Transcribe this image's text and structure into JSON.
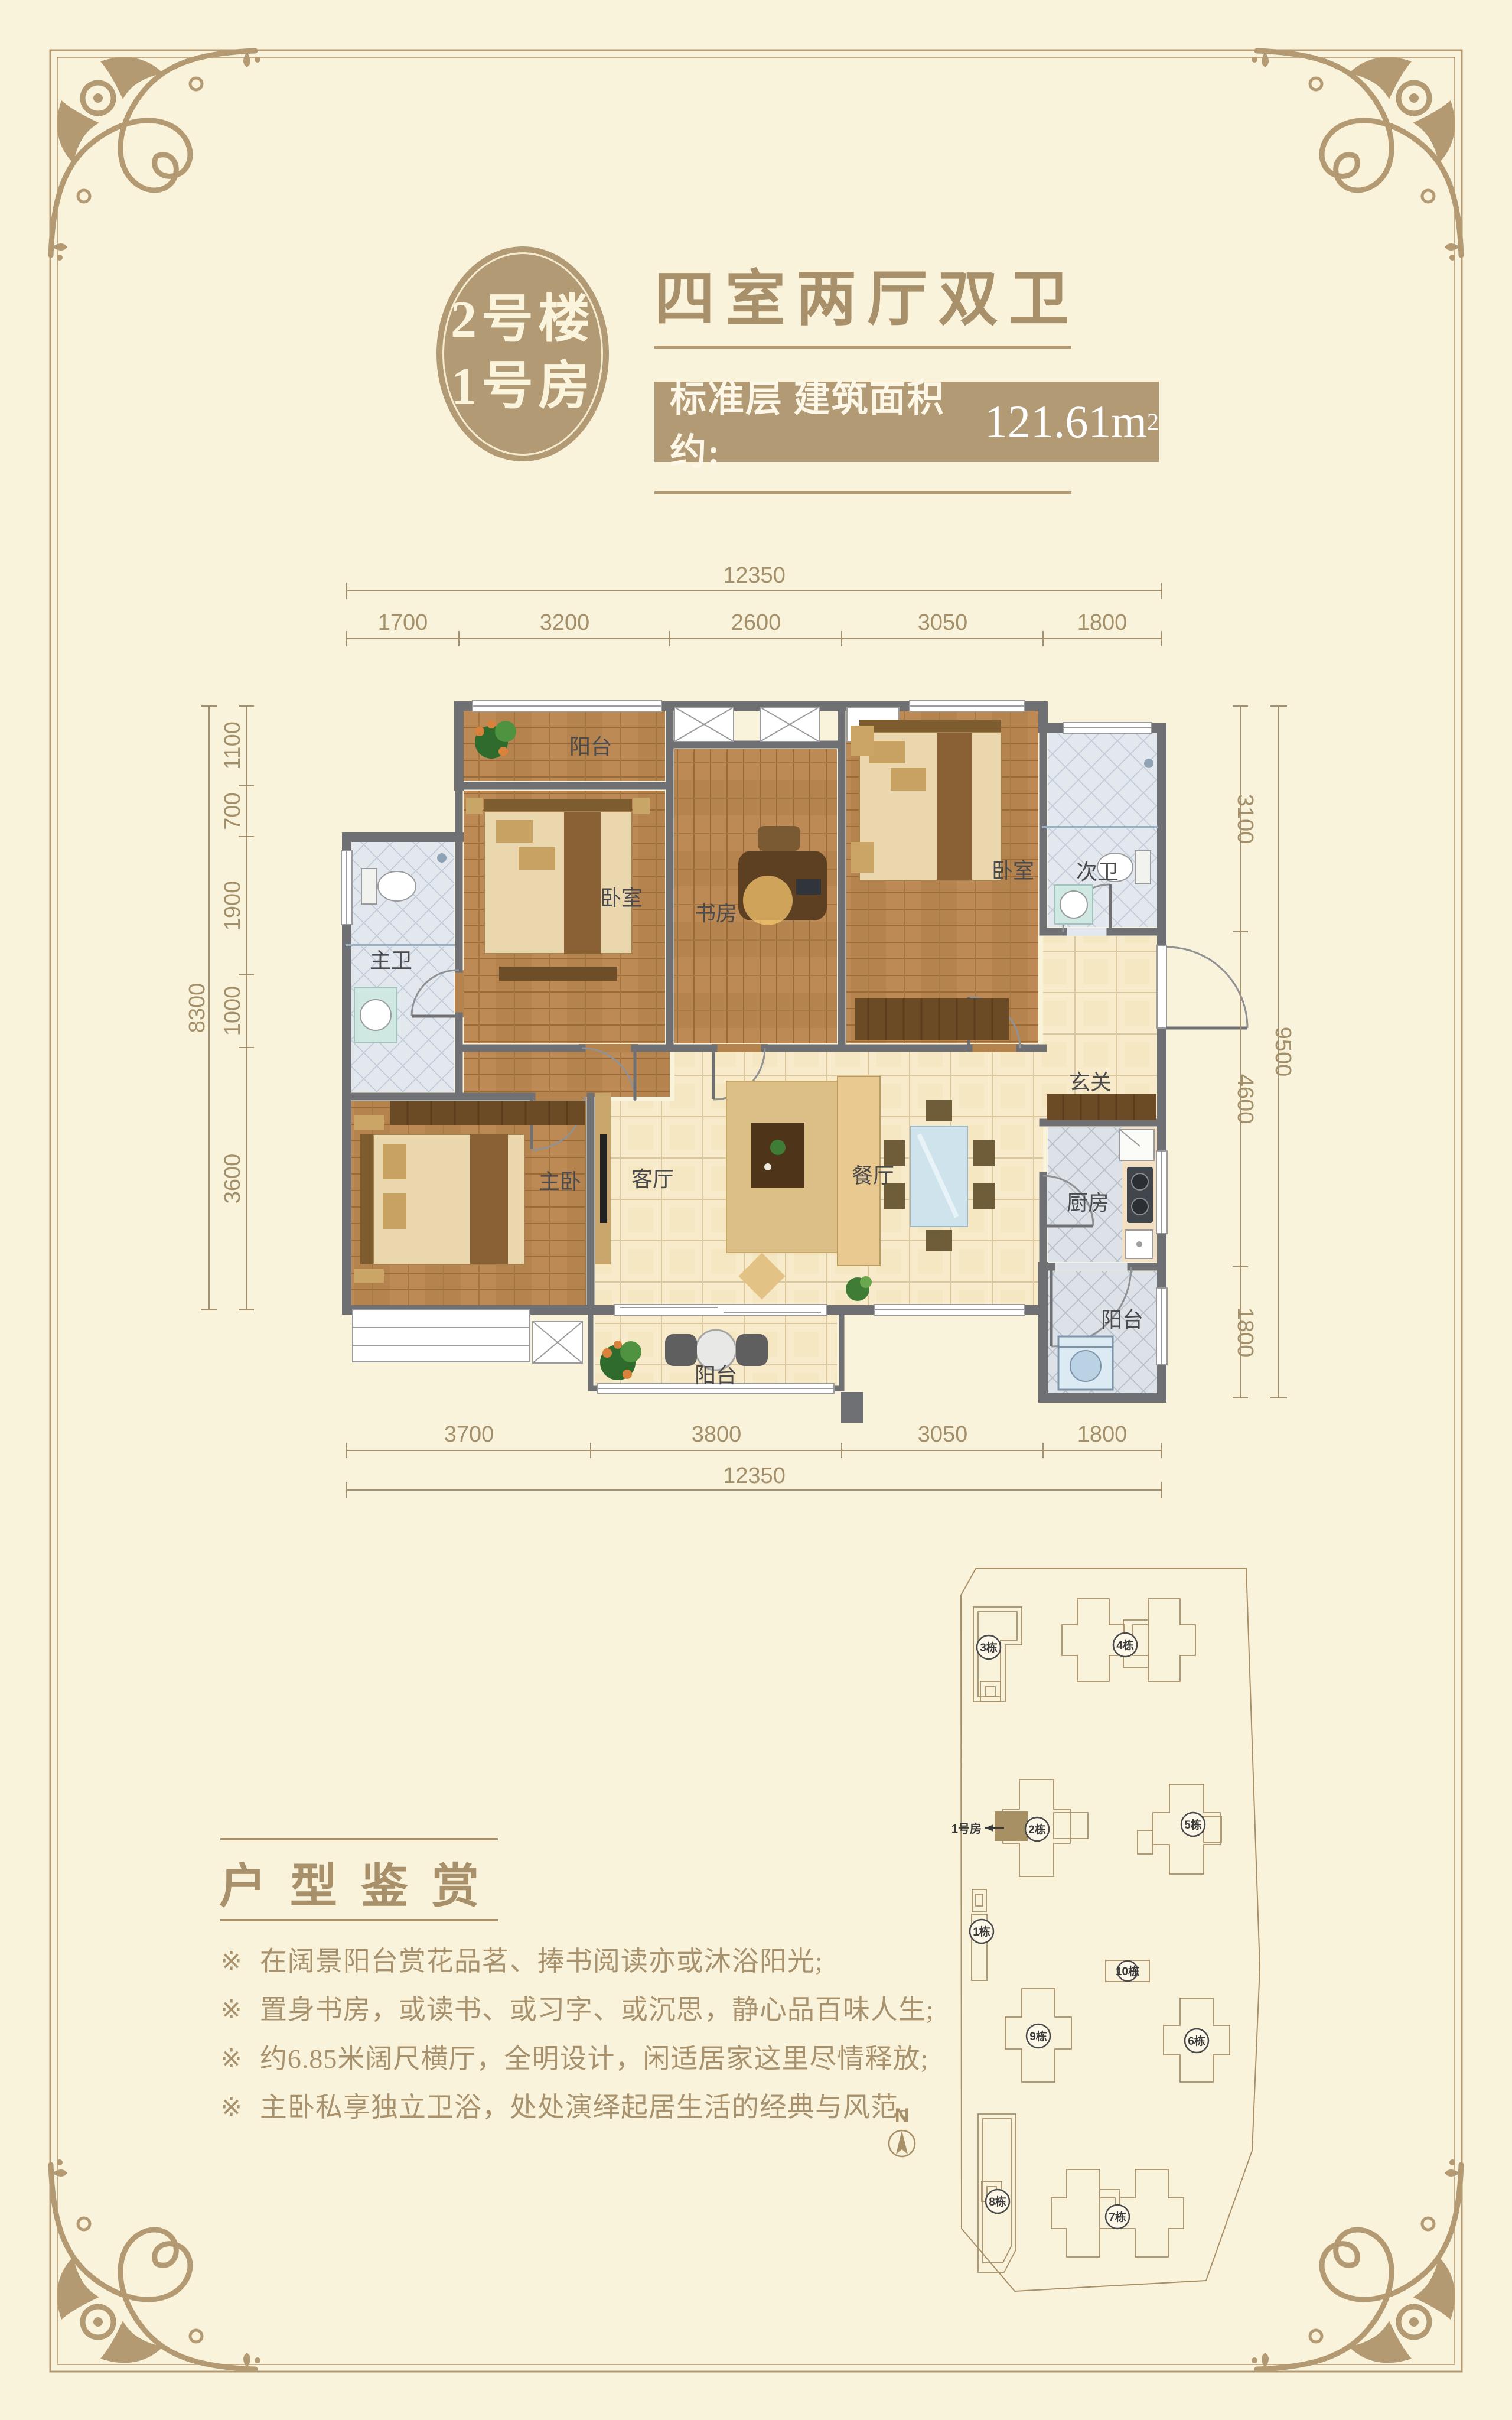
{
  "page": {
    "bg": "#faf3dc",
    "accent": "#b49a72",
    "accent_dark": "#a8906a",
    "banner_bg": "#b29a75",
    "wall": "#6e7073"
  },
  "badge": {
    "line1": "2号楼",
    "line2": "1号房"
  },
  "header": {
    "title": "四室两厅双卫",
    "area_label": "标准层 建筑面积约:",
    "area_value": "121.61m",
    "area_sup": "2"
  },
  "floorplan": {
    "rooms": {
      "balcony_top": "阳台",
      "bedroom_a": "卧室",
      "study": "书房",
      "bedroom_b": "卧室",
      "bath_second": "次卫",
      "bath_master": "主卫",
      "master": "主卧",
      "living": "客厅",
      "dining": "餐厅",
      "kitchen": "厨房",
      "foyer": "玄关",
      "balcony_bottom": "阳台",
      "balcony_service": "阳台"
    },
    "dims": {
      "top": {
        "total": "12350",
        "segs": [
          "1700",
          "3200",
          "2600",
          "3050",
          "1800"
        ]
      },
      "bottom": {
        "total": "12350",
        "segs": [
          "3700",
          "3800",
          "3050",
          "1800"
        ]
      },
      "left": {
        "total": "8300",
        "segs": [
          "1100",
          "700",
          "1900",
          "1000",
          "3600"
        ]
      },
      "right": {
        "total": "9500",
        "segs": [
          "3100",
          "4600",
          "1800"
        ]
      }
    }
  },
  "siteplan": {
    "unit_label": "1号房",
    "compass": "N",
    "buildings": {
      "b1": "1栋",
      "b2": "2栋",
      "b3": "3栋",
      "b4": "4栋",
      "b5": "5栋",
      "b6": "6栋",
      "b7": "7栋",
      "b8": "8栋",
      "b9": "9栋",
      "b10": "10栋"
    }
  },
  "appreciation": {
    "title": "户型鉴赏",
    "marker": "※",
    "bullets": [
      "在阔景阳台赏花品茗、捧书阅读亦或沐浴阳光;",
      "置身书房，或读书、或习字、或沉思，静心品百味人生;",
      "约6.85米阔尺横厅，全明设计，闲适居家这里尽情释放;",
      "主卧私享独立卫浴，处处演绎起居生活的经典与风范。"
    ]
  }
}
